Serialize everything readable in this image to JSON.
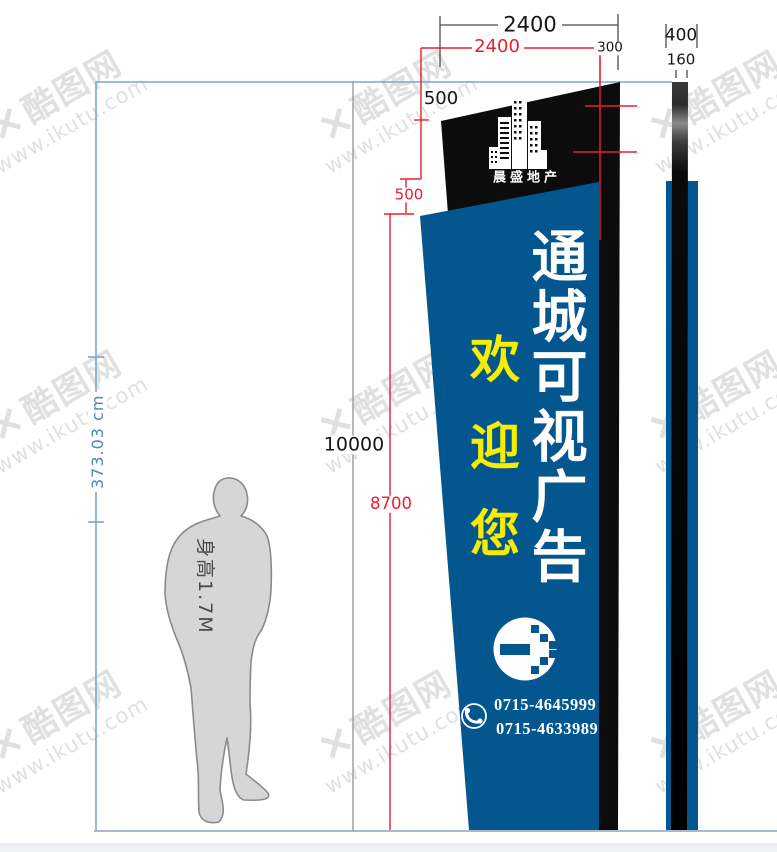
{
  "watermark": {
    "brand": "酷图网",
    "mark": "×",
    "url": "www.ikutu.com"
  },
  "dimensions": {
    "top_width_black": "2400",
    "top_width_red": "2400",
    "top_offset": "300",
    "header_height_black": "500",
    "header_height_red": "500",
    "total_height": "10000",
    "panel_height": "8700",
    "side_width": "400",
    "side_depth": "160",
    "reference_height": "373.03 cm"
  },
  "sign": {
    "logo_company": "晨盛地产",
    "main_slogan": "通城可视广告",
    "welcome": "欢迎您",
    "phone_line1": "0715-4645999",
    "phone_line2": "0715-4633989"
  },
  "figure": {
    "height_label": "身高1.7M"
  },
  "colors": {
    "panel_blue": "#04568f",
    "panel_black": "#0c0c0c",
    "dim_red": "#e8202e",
    "dim_blue_line": "#7ba6d0",
    "accent_yellow": "#f5ee00"
  }
}
